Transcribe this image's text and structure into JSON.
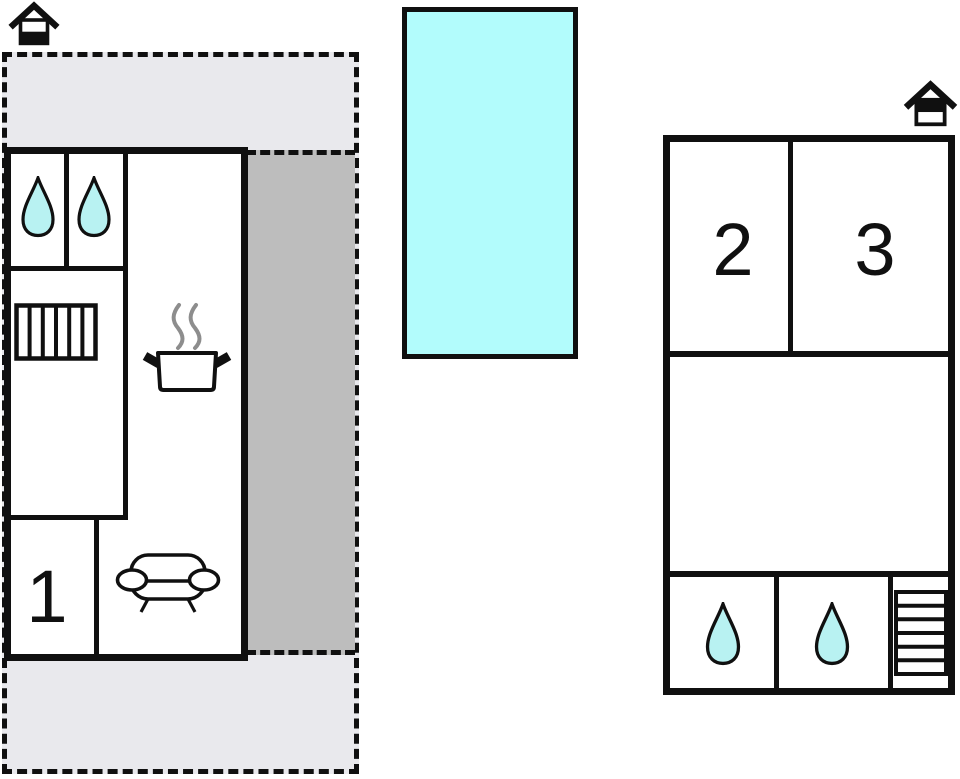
{
  "plan": {
    "type": "vacation-house-floor-plan",
    "floors": [
      {
        "name": "ground-floor",
        "marker": "house-ground-floor-icon",
        "rooms": [
          {
            "label": "1",
            "type": "bedroom"
          },
          {
            "type": "bathroom",
            "icons": [
              "water-drop",
              "water-drop"
            ]
          },
          {
            "type": "hall",
            "icons": [
              "stairs-vertical"
            ]
          },
          {
            "type": "kitchen",
            "icons": [
              "cooking-pot-with-steam"
            ]
          },
          {
            "type": "living-room",
            "icons": [
              "sofa"
            ]
          }
        ],
        "outdoor": [
          "open-terrace-dashed",
          "covered-terrace-dark"
        ]
      },
      {
        "name": "upper-floor",
        "marker": "house-upper-floor-icon",
        "rooms": [
          {
            "label": "2",
            "type": "bedroom"
          },
          {
            "label": "3",
            "type": "bedroom"
          },
          {
            "type": "landing"
          },
          {
            "type": "bathroom",
            "icons": [
              "water-drop"
            ]
          },
          {
            "type": "bathroom",
            "icons": [
              "water-drop"
            ]
          },
          {
            "type": "stairwell",
            "icons": [
              "stairs-horizontal"
            ]
          }
        ]
      }
    ],
    "pool": {
      "name": "swimming-pool"
    }
  },
  "rooms": {
    "room1": "1",
    "room2": "2",
    "room3": "3"
  },
  "colors": {
    "wall": "#101010",
    "terrace_light": "#e9e9ed",
    "terrace_dark": "#bdbdbd",
    "pool": "#b2fcfc",
    "drop": "#b8f2f2",
    "steam": "#8d8d8d",
    "white": "#ffffff"
  }
}
